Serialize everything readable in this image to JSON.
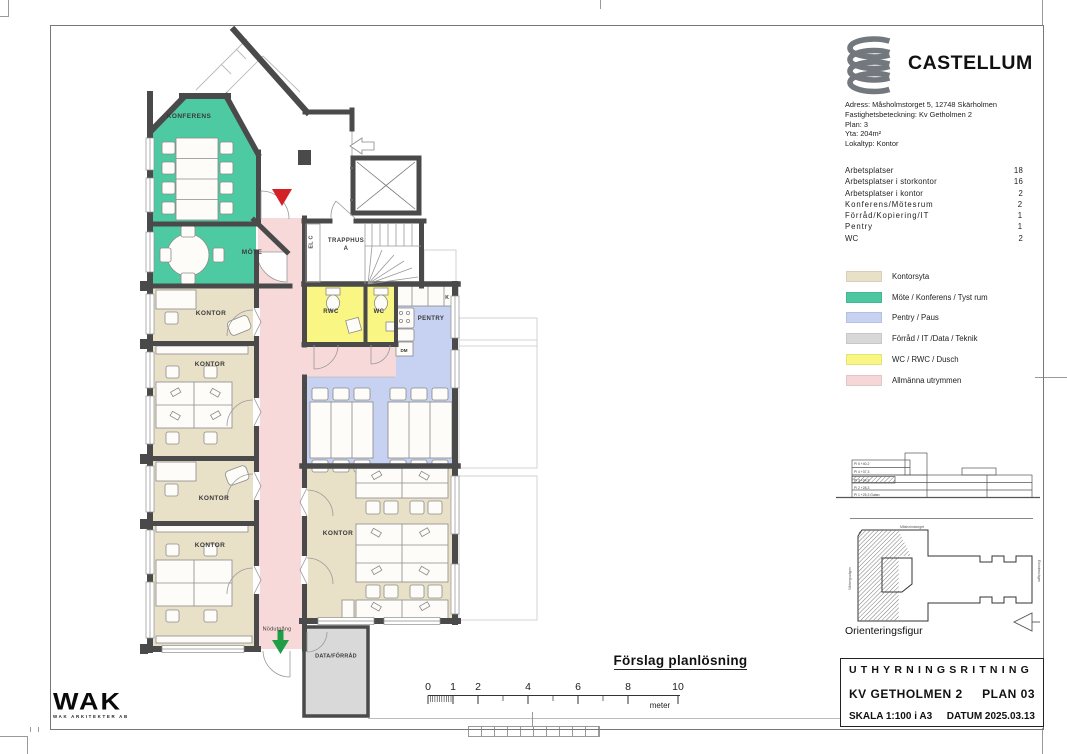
{
  "brand": {
    "name": "CASTELLUM"
  },
  "info": {
    "address": "Adress: Måsholmstorget 5, 12748 Skärholmen",
    "property": "Fastighetsbeteckning: Kv Getholmen 2",
    "plan": "Plan: 3",
    "area": "Yta: 204m²",
    "type": "Lokaltyp: Kontor"
  },
  "stats": {
    "rows": [
      {
        "label": "Arbetsplatser",
        "value": "18"
      },
      {
        "label": "Arbetsplatser i storkontor",
        "value": "16"
      },
      {
        "label": "Arbetsplatser i kontor",
        "value": "2"
      },
      {
        "label": "Konferens/Mötesrum",
        "value": "2"
      },
      {
        "label": "Förråd/Kopiering/IT",
        "value": "1"
      },
      {
        "label": "Pentry",
        "value": "1"
      },
      {
        "label": "WC",
        "value": "2"
      }
    ]
  },
  "legend": {
    "items": [
      {
        "label": "Kontorsyta",
        "color": "#e9e0c8"
      },
      {
        "label": "Möte / Konferens / Tyst rum",
        "color": "#4cc7a0"
      },
      {
        "label": "Pentry / Paus",
        "color": "#c7d1f1"
      },
      {
        "label": "Förråd / IT /Data / Teknik",
        "color": "#d8d8d8"
      },
      {
        "label": "WC / RWC / Dusch",
        "color": "#f9f684"
      },
      {
        "label": "Allmänna utrymmen",
        "color": "#f6d6d7"
      }
    ]
  },
  "plan": {
    "rooms": {
      "konferens": "KONFERENS",
      "mote": "MÖTE",
      "kontor": "KONTOR",
      "trapphus_line1": "TRAPPHUS",
      "trapphus_line2": "A",
      "elc": "EL C",
      "rwc": "RWC",
      "wc": "WC",
      "pentry": "PENTRY",
      "k": "K",
      "dm": "DM",
      "data_forrad": "DATA/FÖRRÅD",
      "nodutgang": "Nödutgång"
    },
    "marker_red": "#d42127",
    "marker_green": "#1f9e46"
  },
  "orientering": {
    "caption": "Orienteringsfigur",
    "floors": [
      "Pl 5  +40,2",
      "Pl 4  +37,3",
      "Pl 3  +34,3",
      "Pl 2  +28,3",
      "Pl 1  +25,3 Gatan"
    ],
    "streets": {
      "top": "Måsholmstorget",
      "left": "Vårbergsvägen",
      "right": "Ekholmsvägen"
    }
  },
  "titleblock": {
    "line1": "UTHYRNINGSRITNING",
    "line2_left": "KV  GETHOLMEN 2",
    "line2_right": "PLAN 03",
    "line3_left": "SKALA 1:100 i A3",
    "line3_right": "DATUM 2025.03.13"
  },
  "footer": {
    "plan_title": "Förslag planlösning",
    "scale": {
      "labels": [
        "0",
        "1",
        "2",
        "4",
        "6",
        "8",
        "10"
      ],
      "unit": "meter"
    }
  },
  "wak": {
    "name": "WAK",
    "sub": "WAK ARKITEKTER AB"
  }
}
